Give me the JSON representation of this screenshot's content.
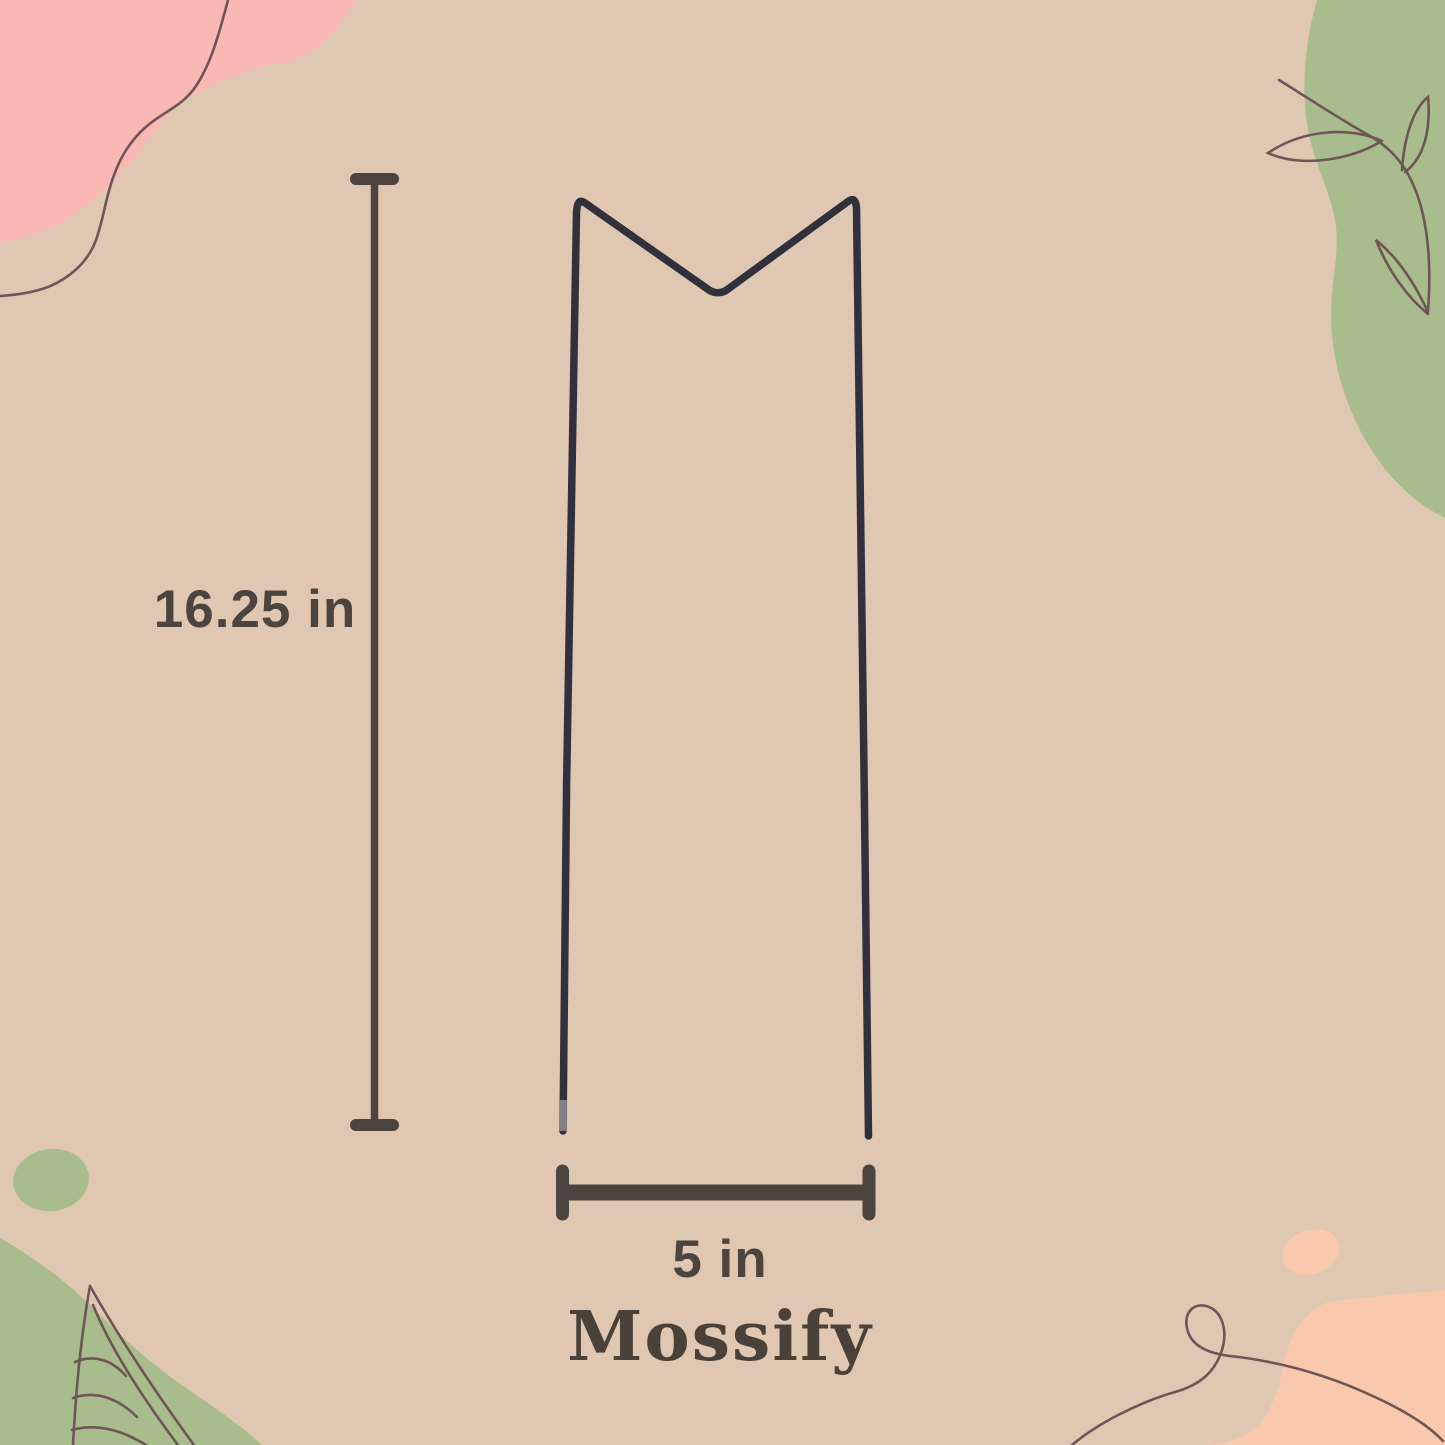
{
  "labels": {
    "height": "16.25 in",
    "width": "5 in"
  },
  "brand": {
    "name": "Mossify"
  },
  "colors": {
    "background": "#e0c7b2",
    "pink_blob": "#f9b8b3",
    "green_blob": "#a9bc8d",
    "peach_blob": "#f9c9ae",
    "line_art": "#6f5555",
    "dimension_marks": "#4c443e",
    "text": "#4c443e",
    "wire": "#30313c",
    "wire_tip": "#9b9b9f"
  },
  "decor": {
    "top_left": "pink-blob-with-squiggle-line",
    "top_right": "green-blob-with-leafy-vine-line-art",
    "bottom_left": "green-blob-with-leaf-line-art-and-dot",
    "bottom_right": "peach-blob-with-loop-line-and-dot"
  },
  "product": {
    "depicted": "v-top wire plant stake"
  }
}
